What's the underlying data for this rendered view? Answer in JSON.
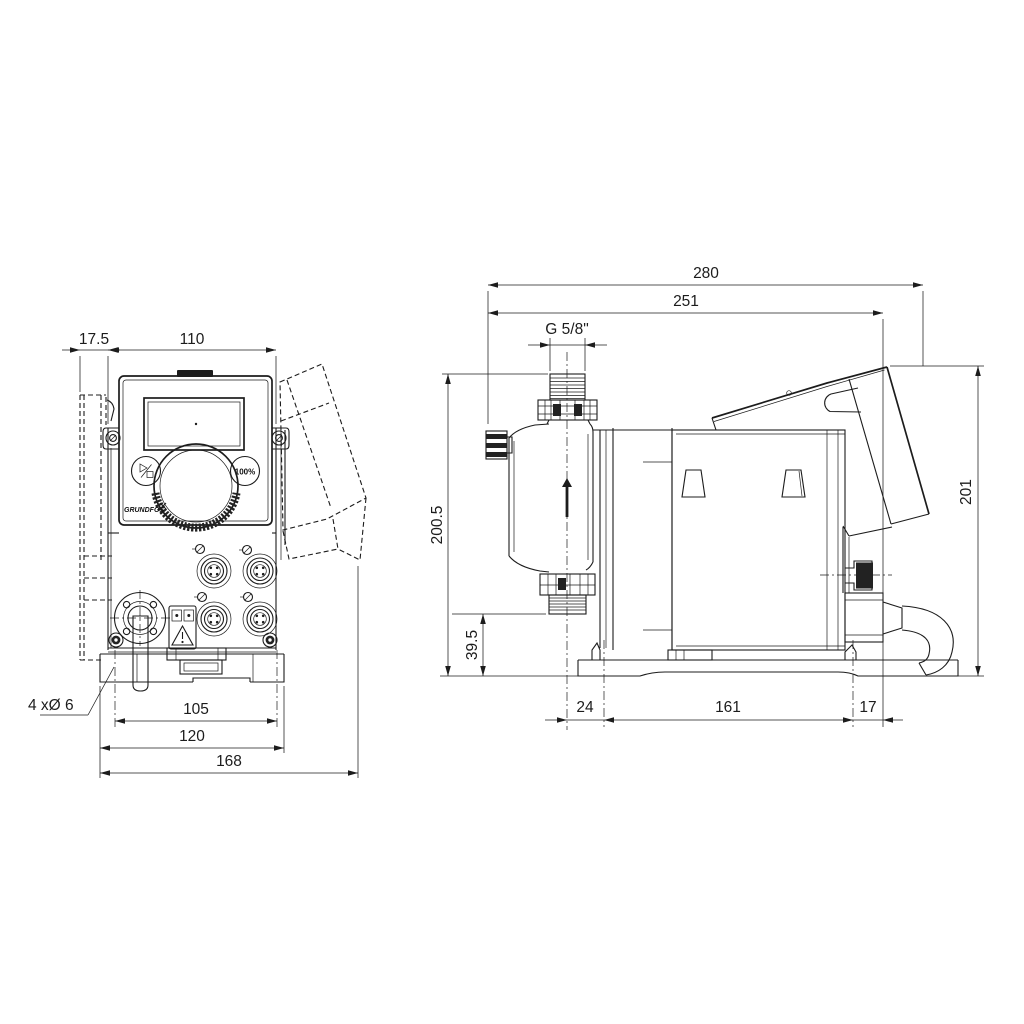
{
  "title": "Dosing pump dimensional drawing",
  "colors": {
    "background": "#ffffff",
    "line": "#1c1c1c"
  },
  "front_view": {
    "dim_wall_offset": "17.5",
    "dim_top_width": "110",
    "dim_hole_spacing": "105",
    "dim_plate_width": "120",
    "dim_overall_width": "168",
    "note_mounting_holes": "4 xØ 6",
    "control_panel": {
      "brand": "GRUNDFOS",
      "button_100_label": "100%"
    }
  },
  "side_view": {
    "dim_overall_length": "280",
    "dim_length_to_clamp": "251",
    "dim_connection_thread": "G 5/8\"",
    "dim_height_overall": "200.5",
    "dim_valve_height": "39.5",
    "dim_center_to_hole": "24",
    "dim_hole_spacing": "161",
    "dim_hole_to_end": "17",
    "dim_height_rear": "201"
  }
}
